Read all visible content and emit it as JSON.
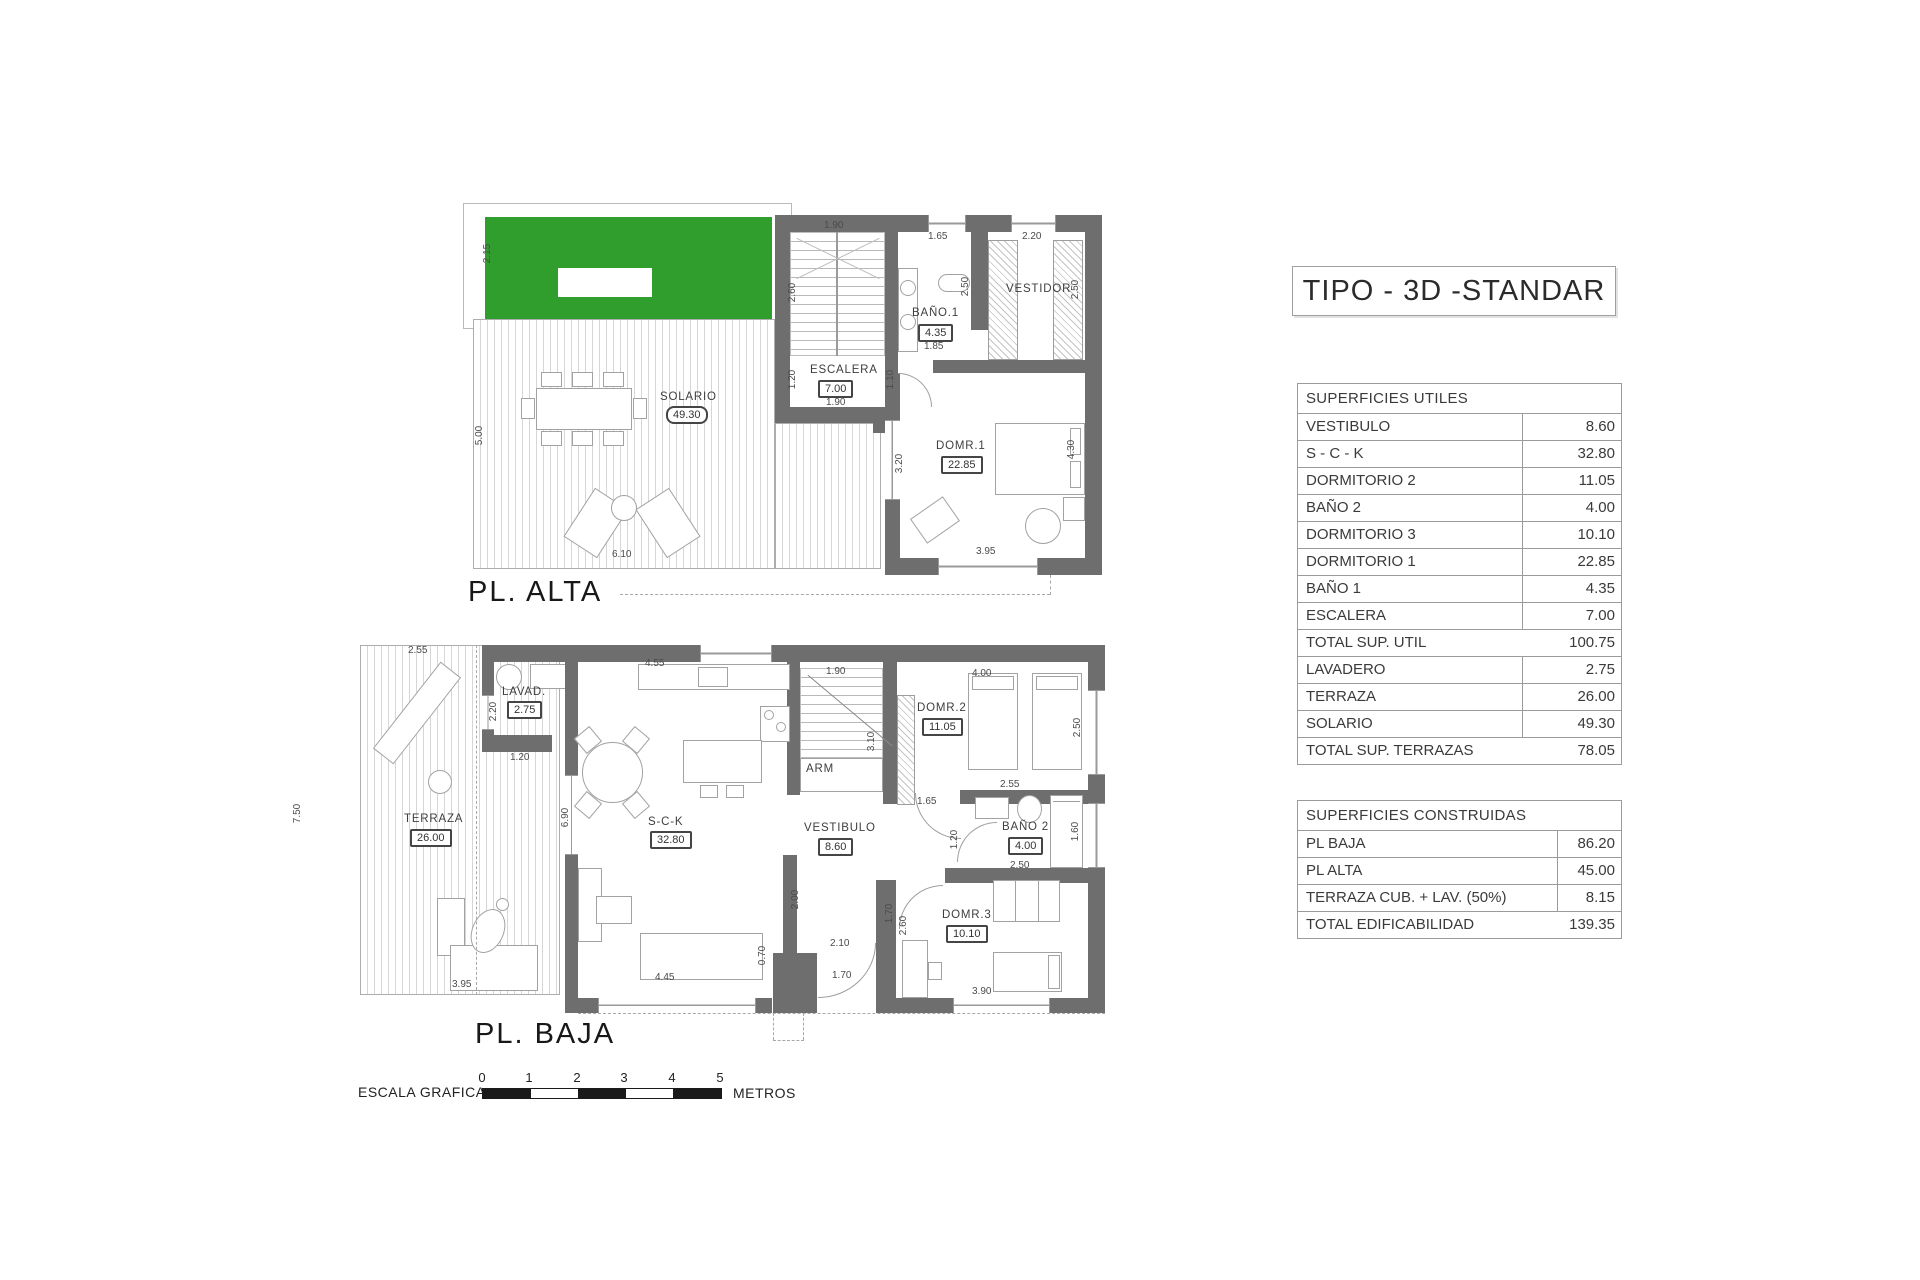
{
  "title_box": {
    "label": "TIPO - 3D -STANDAR"
  },
  "plans": {
    "alta": {
      "caption": "PL. ALTA",
      "solario": {
        "name": "SOLARIO",
        "area": "49.30"
      },
      "escalera": {
        "name": "ESCALERA",
        "area": "7.00"
      },
      "bano1": {
        "name": "BAÑO.1",
        "area": "4.35"
      },
      "vestidor": {
        "name": "VESTIDOR"
      },
      "dorm1": {
        "name": "DOMR.1",
        "area": "22.85"
      },
      "dims": [
        "2.15",
        "5.00",
        "6.10",
        "1.90",
        "2.60",
        "1.20",
        "1.90",
        "1.10",
        "1.65",
        "2.50",
        "1.85",
        "2.20",
        "2.50",
        "3.20",
        "4.30",
        "3.95"
      ]
    },
    "baja": {
      "caption": "PL. BAJA",
      "terraza": {
        "name": "TERRAZA",
        "area": "26.00"
      },
      "lavad": {
        "name": "LAVAD.",
        "area": "2.75"
      },
      "sck": {
        "name": "S-C-K",
        "area": "32.80"
      },
      "vestibulo": {
        "name": "VESTIBULO",
        "area": "8.60"
      },
      "arm": {
        "name": "ARM"
      },
      "dorm2": {
        "name": "DOMR.2",
        "area": "11.05"
      },
      "bano2": {
        "name": "BAÑO 2",
        "area": "4.00"
      },
      "dorm3": {
        "name": "DOMR.3",
        "area": "10.10"
      },
      "dims": [
        "2.55",
        "7.50",
        "3.95",
        "2.20",
        "1.20",
        "4.55",
        "6.90",
        "1.90",
        "3.10",
        "1.65",
        "4.00",
        "2.50",
        "2.55",
        "1.20",
        "1.60",
        "2.50",
        "2.00",
        "2.10",
        "1.70",
        "1.70",
        "2.60",
        "0.70",
        "4.45",
        "3.90"
      ]
    }
  },
  "tables": {
    "utiles": {
      "header": "SUPERFICIES UTILES",
      "rows": [
        {
          "label": "VESTIBULO",
          "value": "8.60"
        },
        {
          "label": "S - C - K",
          "value": "32.80"
        },
        {
          "label": "DORMITORIO 2",
          "value": "11.05"
        },
        {
          "label": "BAÑO 2",
          "value": "4.00"
        },
        {
          "label": "DORMITORIO 3",
          "value": "10.10"
        },
        {
          "label": "DORMITORIO 1",
          "value": "22.85"
        },
        {
          "label": "BAÑO 1",
          "value": "4.35"
        },
        {
          "label": "ESCALERA",
          "value": "7.00"
        },
        {
          "label": "TOTAL SUP. UTIL",
          "value": "100.75"
        },
        {
          "label": "LAVADERO",
          "value": "2.75"
        },
        {
          "label": "TERRAZA",
          "value": "26.00"
        },
        {
          "label": "SOLARIO",
          "value": "49.30"
        },
        {
          "label": "TOTAL SUP. TERRAZAS",
          "value": "78.05"
        }
      ]
    },
    "construidas": {
      "header": "SUPERFICIES CONSTRUIDAS",
      "rows": [
        {
          "label": "PL BAJA",
          "value": "86.20"
        },
        {
          "label": "PL ALTA",
          "value": "45.00"
        },
        {
          "label": "TERRAZA CUB. + LAV. (50%)",
          "value": "8.15"
        },
        {
          "label": "TOTAL EDIFICABILIDAD",
          "value": "139.35"
        }
      ]
    }
  },
  "scale_bar": {
    "label": "ESCALA GRAFICA :",
    "ticks": [
      "0",
      "1",
      "2",
      "3",
      "4",
      "5"
    ],
    "unit": "METROS"
  },
  "colors": {
    "grass": "#2f9e2d",
    "wall": "#6e6e6e"
  }
}
